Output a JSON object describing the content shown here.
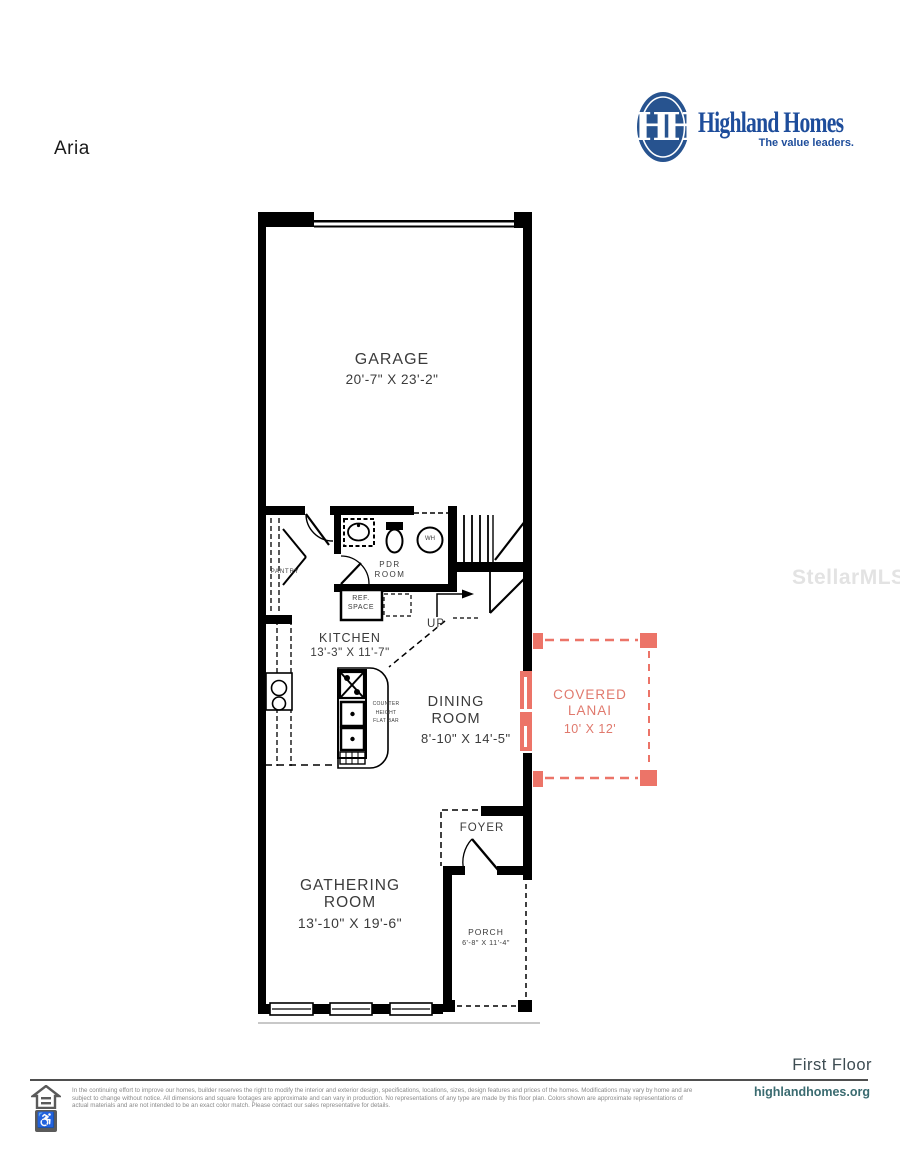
{
  "page": {
    "plan_name": "Aria",
    "floor_label": "First Floor",
    "website": "highlandhomes.org",
    "watermark": "StellarMLS"
  },
  "logo": {
    "monogram": "HH",
    "brand": "Highland Homes",
    "tagline": "The value leaders."
  },
  "colors": {
    "wall_black": "#000000",
    "lanai_accent": "#ec7468",
    "brand_blue": "#1e4d9b",
    "label_gray": "#3b3b3b"
  },
  "rooms": {
    "garage": {
      "name": "GARAGE",
      "dims": "20'-7\" X 23'-2\""
    },
    "kitchen": {
      "name": "KITCHEN",
      "dims": "13'-3\" X 11'-7\""
    },
    "dining": {
      "name": "DINING ROOM",
      "dims": "8'-10\" X 14'-5\""
    },
    "lanai": {
      "name": "COVERED LANAI",
      "dims": "10' X 12'"
    },
    "gathering": {
      "name": "GATHERING ROOM",
      "dims": "13'-10\" X 19'-6\""
    },
    "foyer": {
      "name": "FOYER"
    },
    "porch": {
      "name": "PORCH",
      "dims": "6'-8\" X 11'-4\""
    },
    "pdr": {
      "name": "PDR ROOM"
    },
    "pantry": {
      "name": "PANTRY"
    },
    "ref_space": {
      "name": "REF. SPACE"
    },
    "water_heater": {
      "name": "WH"
    },
    "stairs": {
      "name": "UP"
    },
    "flat_bar": {
      "name": "COUNTER HEIGHT FLAT BAR"
    }
  },
  "footer": {
    "disclaimer": "In the continuing effort to improve our homes, builder reserves the right to modify the interior and exterior design, specifications, locations, sizes, design features and prices of the homes. Modifications may vary by home and are subject to change without notice. All dimensions and square footages are approximate and can vary in production. No representations of any type are made by this floor plan. Colors shown are approximate representations of actual materials and are not intended to be an exact color match. Please contact our sales representative for details."
  }
}
